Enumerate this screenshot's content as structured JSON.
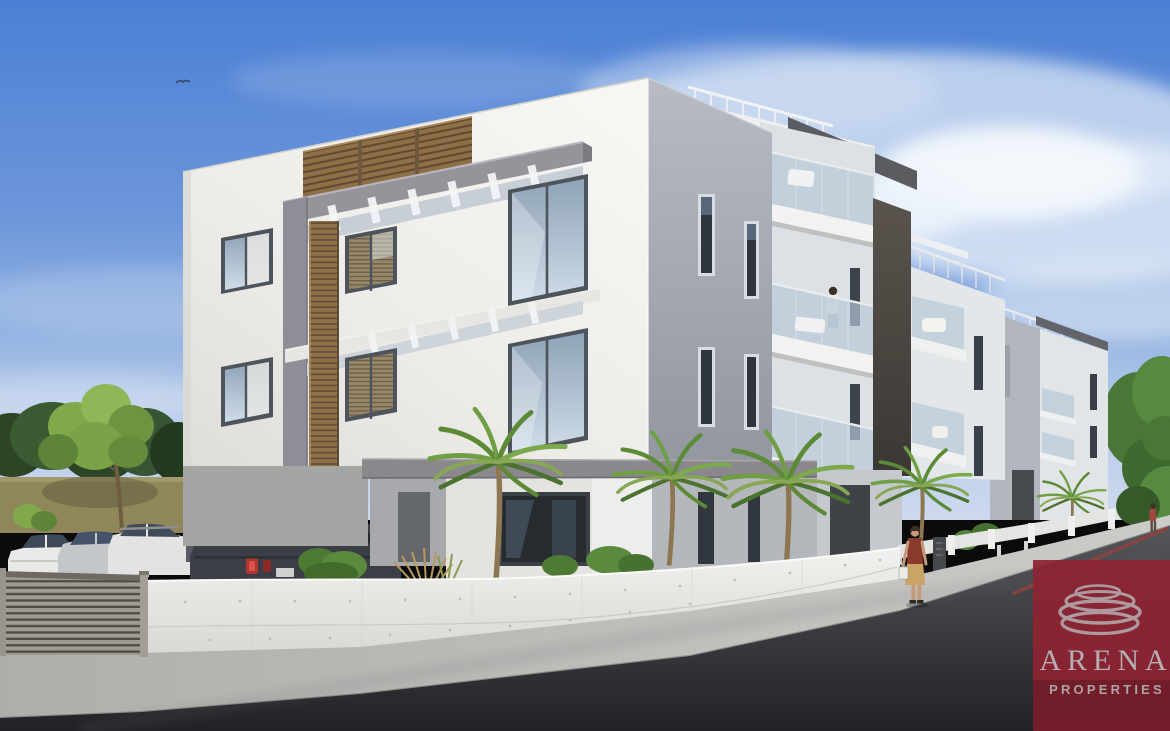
{
  "image": {
    "type": "architectural-render",
    "description": "Modern three-storey apartment complex with wooden louver accents, glass balconies, palm trees, parked cars behind a slatted gate, pedestrians on the sidewalk and a curving street"
  },
  "watermark": {
    "brand": "ARENA",
    "tagline": "PROPERTIES",
    "panel_color": "#8E2433",
    "logo_color": "#B5AFB1",
    "text_color": "#B5AFB1"
  },
  "scene": {
    "colors": {
      "sky_top": "#4B80D5",
      "sky_horizon": "#CDD9EE",
      "facade_white": "#F5F4F1",
      "facade_gray": "#A9AEB8",
      "wood_accent": "#8F7049",
      "frame_gray": "#94939A",
      "window_frame": "#4E545B",
      "balcony_glass": "#B7C9D7",
      "foliage_dark": "#33502E",
      "foliage_bright": "#7FA94A",
      "olive_boundary_wall": "#8F8759",
      "street_wall": "#EFEFED",
      "gate_metal": "#9B958C",
      "road": "#3A3B3F",
      "sidewalk": "#B9BAB6",
      "suv": "#3B3F45",
      "car_white": "#E9EAE8",
      "car_silver": "#C4C7CA",
      "tail_light": "#B23530",
      "pedestrian_top": "#8A3A2B",
      "pedestrian_skirt": "#C9A465"
    },
    "objects": [
      "sky",
      "clouds",
      "flying-bird",
      "background-trees",
      "olive-boundary-wall",
      "green-tree",
      "parked-cars",
      "dark-suv",
      "main-apartment-building",
      "wooden-louver-screen",
      "pergola-frame",
      "apartment-buildings-row",
      "balconies-with-glass-railings",
      "person-on-balcony",
      "palm-trees",
      "ornamental-grasses",
      "white-perimeter-wall",
      "driveway-gate",
      "sidewalk",
      "asphalt-road",
      "walking-woman",
      "distant-pedestrian",
      "arena-properties-watermark"
    ]
  }
}
